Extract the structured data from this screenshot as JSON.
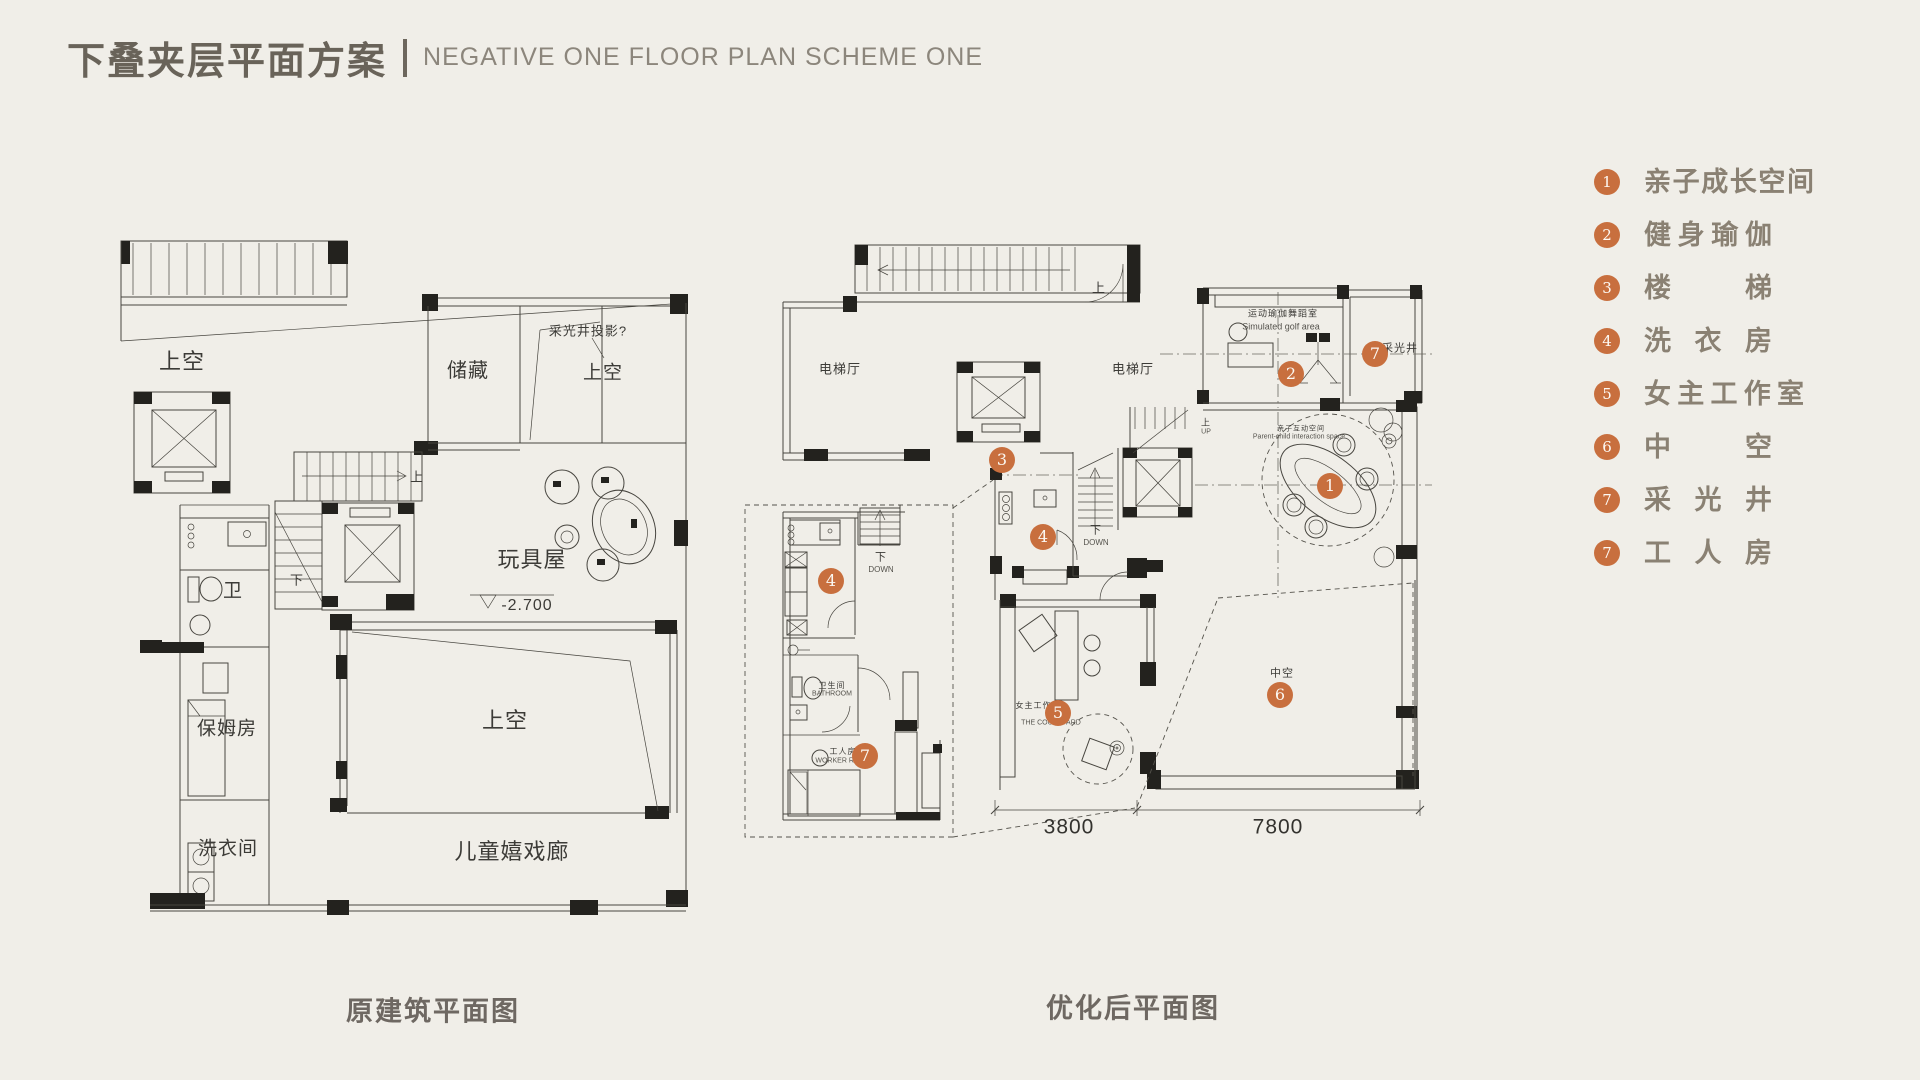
{
  "header": {
    "title_zh": "下叠夹层平面方案",
    "title_en": "NEGATIVE ONE FLOOR PLAN SCHEME ONE"
  },
  "colors": {
    "background": "#f0eee8",
    "accent_orange": "#c86f3e",
    "title_text": "#696359",
    "subtitle_text": "#8c867c",
    "legend_text": "#8a8173",
    "line_color": "#47453f"
  },
  "legend": {
    "items": [
      {
        "num": "1",
        "label": "亲子成长空间",
        "width": 170
      },
      {
        "num": "2",
        "label": "健身瑜伽",
        "width": 128
      },
      {
        "num": "3",
        "label": "楼梯",
        "width": 128
      },
      {
        "num": "4",
        "label": "洗衣房",
        "width": 128
      },
      {
        "num": "5",
        "label": "女主工作室",
        "width": 160
      },
      {
        "num": "6",
        "label": "中空",
        "width": 128
      },
      {
        "num": "7",
        "label": "采光井",
        "width": 128
      },
      {
        "num": "7",
        "label": "工人房",
        "width": 128
      }
    ]
  },
  "captions": {
    "left": "原建筑平面图",
    "right": "优化后平面图"
  },
  "left_plan": {
    "labels": [
      {
        "text": "上空",
        "x": 182,
        "y": 362,
        "size": 22
      },
      {
        "text": "储藏",
        "x": 468,
        "y": 371,
        "size": 20
      },
      {
        "text": "采光井投影?",
        "x": 588,
        "y": 331,
        "size": 13
      },
      {
        "text": "上空",
        "x": 603,
        "y": 373,
        "size": 19
      },
      {
        "text": "上",
        "x": 417,
        "y": 477,
        "size": 13
      },
      {
        "text": "下",
        "x": 297,
        "y": 580,
        "size": 13
      },
      {
        "text": "玩具屋",
        "x": 532,
        "y": 560,
        "size": 22
      },
      {
        "text": "-2.700",
        "x": 527,
        "y": 606,
        "size": 16
      },
      {
        "text": "卫",
        "x": 233,
        "y": 591,
        "size": 19
      },
      {
        "text": "保姆房",
        "x": 227,
        "y": 729,
        "size": 19
      },
      {
        "text": "洗衣间",
        "x": 228,
        "y": 849,
        "size": 19
      },
      {
        "text": "上空",
        "x": 505,
        "y": 721,
        "size": 22
      },
      {
        "text": "儿童嬉戏廊",
        "x": 512,
        "y": 852,
        "size": 22
      }
    ]
  },
  "right_plan": {
    "labels": [
      {
        "text": "上",
        "x": 1099,
        "y": 288,
        "size": 13
      },
      {
        "text": "电梯厅",
        "x": 840,
        "y": 369,
        "size": 13
      },
      {
        "text": "电梯厅",
        "x": 1133,
        "y": 369,
        "size": 13
      },
      {
        "text": "运动瑜伽舞蹈室",
        "x": 1283,
        "y": 314,
        "size": 9
      },
      {
        "text": "Simulated golf area",
        "x": 1281,
        "y": 327,
        "size": 9,
        "cls": "en"
      },
      {
        "text": "采光井",
        "x": 1400,
        "y": 349,
        "size": 11
      },
      {
        "text": "亲子互动空间",
        "x": 1301,
        "y": 429,
        "size": 7
      },
      {
        "text": "Parent-child interaction space",
        "x": 1299,
        "y": 437,
        "size": 7,
        "cls": "en"
      },
      {
        "text": "上",
        "x": 1206,
        "y": 423,
        "size": 9
      },
      {
        "text": "UP",
        "x": 1206,
        "y": 432,
        "size": 7,
        "cls": "en"
      },
      {
        "text": "下",
        "x": 1096,
        "y": 531,
        "size": 11
      },
      {
        "text": "DOWN",
        "x": 1096,
        "y": 543,
        "size": 8,
        "cls": "en"
      },
      {
        "text": "下",
        "x": 881,
        "y": 558,
        "size": 11
      },
      {
        "text": "DOWN",
        "x": 881,
        "y": 570,
        "size": 8,
        "cls": "en"
      },
      {
        "text": "卫生间",
        "x": 832,
        "y": 686,
        "size": 8
      },
      {
        "text": "BATHROOM",
        "x": 832,
        "y": 694,
        "size": 7,
        "cls": "en"
      },
      {
        "text": "工人房",
        "x": 843,
        "y": 752,
        "size": 8
      },
      {
        "text": "WORKER ROOM",
        "x": 843,
        "y": 761,
        "size": 7,
        "cls": "en"
      },
      {
        "text": "女主工作室",
        "x": 1038,
        "y": 706,
        "size": 8
      },
      {
        "text": "THE COURTYARD",
        "x": 1051,
        "y": 723,
        "size": 7,
        "cls": "en"
      },
      {
        "text": "中空",
        "x": 1282,
        "y": 674,
        "size": 11
      },
      {
        "text": "3800",
        "x": 1069,
        "y": 827,
        "size": 21,
        "cls": "dim"
      },
      {
        "text": "7800",
        "x": 1278,
        "y": 827,
        "size": 21,
        "cls": "dim"
      }
    ],
    "badges": [
      {
        "num": "3",
        "x": 1002,
        "y": 460
      },
      {
        "num": "2",
        "x": 1291,
        "y": 374
      },
      {
        "num": "7",
        "x": 1375,
        "y": 354
      },
      {
        "num": "1",
        "x": 1330,
        "y": 486
      },
      {
        "num": "4",
        "x": 1043,
        "y": 537
      },
      {
        "num": "4",
        "x": 831,
        "y": 581
      },
      {
        "num": "7",
        "x": 865,
        "y": 756
      },
      {
        "num": "5",
        "x": 1058,
        "y": 713
      },
      {
        "num": "6",
        "x": 1280,
        "y": 695
      }
    ]
  }
}
